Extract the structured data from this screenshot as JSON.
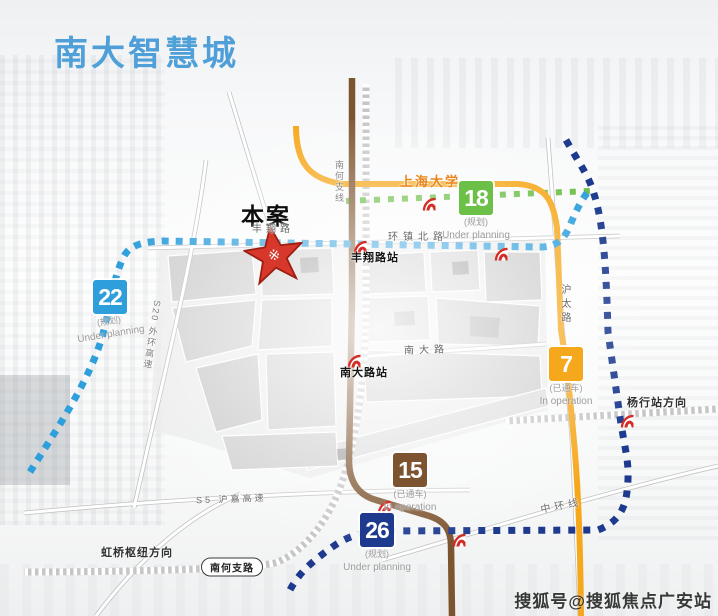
{
  "header": {
    "title": "南大智慧城"
  },
  "watermark": {
    "text": "搜狐号@搜狐焦点广安站"
  },
  "site": {
    "label": "本案"
  },
  "lines": {
    "l22": {
      "num": "22",
      "status_cn": "(规划)",
      "status_en": "Under planning",
      "color": "#2f9fdc"
    },
    "l18": {
      "num": "18",
      "status_cn": "(规划)",
      "status_en": "Under planning",
      "color": "#6cbf47"
    },
    "l7": {
      "num": "7",
      "status_cn": "(已通车)",
      "status_en": "In operation",
      "color": "#f6a81c"
    },
    "l15": {
      "num": "15",
      "status_cn": "(已通车)",
      "status_en": "In operation",
      "color": "#7d5430"
    },
    "l26": {
      "num": "26",
      "status_cn": "(规划)",
      "status_en": "Under planning",
      "color": "#1d3a8e"
    }
  },
  "stations": {
    "fengxianglu": "丰翔路站",
    "nandalu": "南大路站",
    "shanghai_univ": "上海大学"
  },
  "roads": {
    "fengxiang": "丰翔路",
    "huanzhen_north": "环镇北路",
    "nanda": "南大路",
    "hutai": "沪太路",
    "nanhe_branch_rail": "南何支线",
    "s20": "S20 外环高速",
    "s5": "S5 沪嘉高速",
    "midring": "中环线",
    "nanhe_zhilu": "南何支路"
  },
  "directions": {
    "yanghang": "杨行站方向",
    "hongqiao": "虹桥枢纽方向"
  },
  "colors": {
    "title": "#4f9fd8",
    "metro_logo_red": "#d42d26",
    "star_red": "#d8382b"
  }
}
